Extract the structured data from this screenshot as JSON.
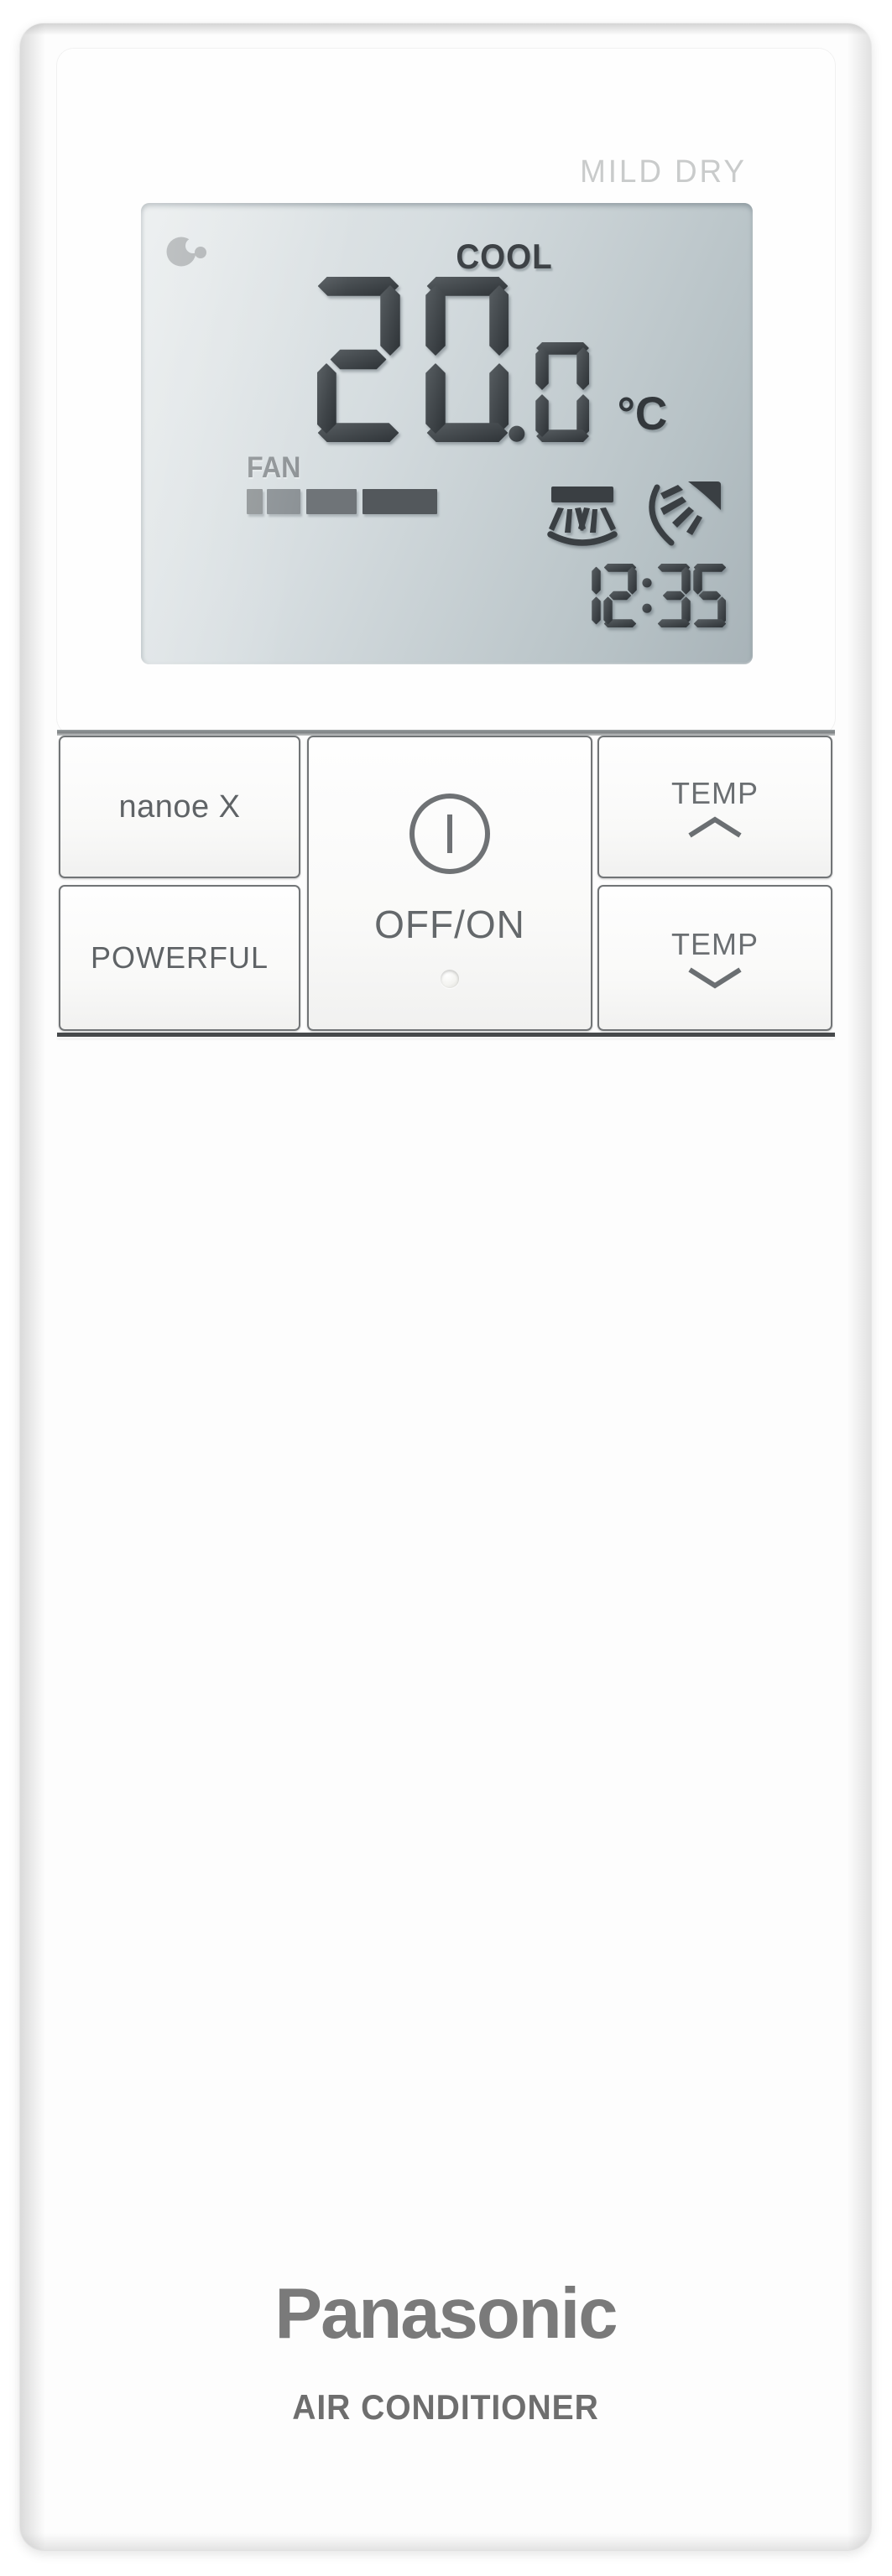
{
  "display": {
    "top_label": "MILD DRY",
    "mode": "COOL",
    "temp_int": "20",
    "temp_frac": ".0",
    "temp_unit": "°C",
    "fan_label": "FAN",
    "fan_bar": {
      "levels": 4,
      "segments": [
        {
          "w": 19,
          "g": 5,
          "c": "#909597"
        },
        {
          "w": 40,
          "g": 7,
          "c": "#8b9195"
        },
        {
          "w": 60,
          "g": 7,
          "c": "#6f7478"
        },
        {
          "w": 89,
          "g": 0,
          "c": "#53585c"
        }
      ]
    },
    "time": "12:35",
    "icons": {
      "nanoe": "nanoe-indicator",
      "swing_vertical": "airswing-vertical",
      "swing_horizontal": "airswing-horizontal"
    },
    "colors": {
      "segment_light": "#575d61",
      "segment_dark": "#2e3337",
      "lcd_bg_light": "#e6eaeb",
      "lcd_bg_dark": "#a8b3b8",
      "inactive_icon": "#a7abad"
    }
  },
  "buttons": {
    "nanoe": "nanoe X",
    "powerful": "POWERFUL",
    "power": "OFF/ON",
    "temp_up": "TEMP",
    "temp_down": "TEMP"
  },
  "branding": {
    "logo": "Panasonic",
    "product": "AIR CONDITIONER"
  }
}
